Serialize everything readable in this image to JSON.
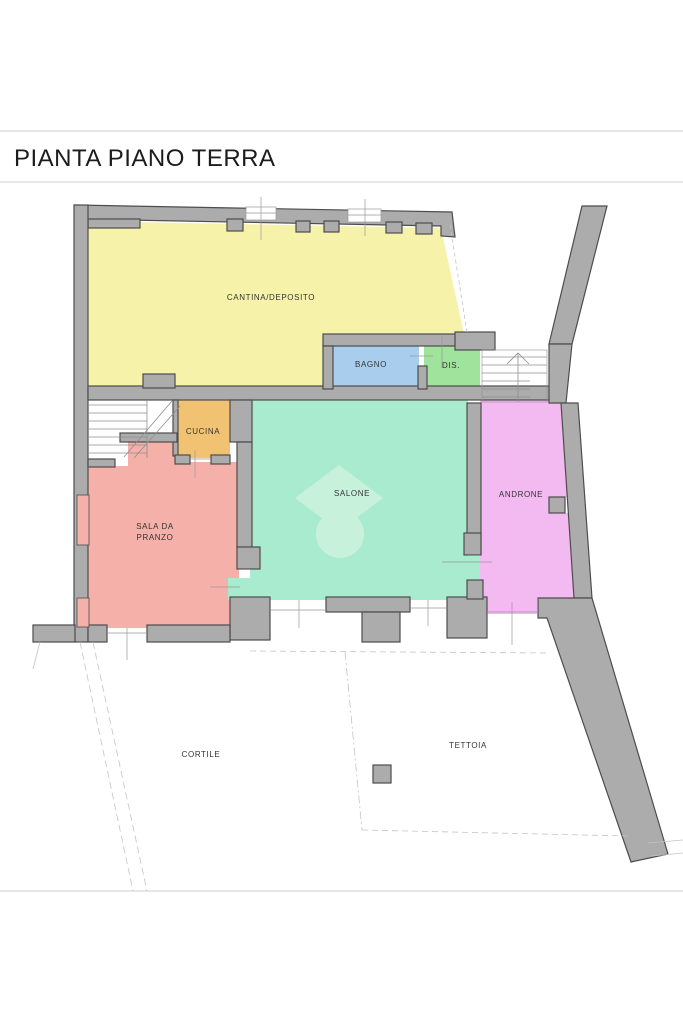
{
  "page": {
    "title": "PIANTA PIANO TERRA"
  },
  "theme": {
    "page_bg": "#ffffff",
    "border_line": "#d8d8d8",
    "title_color": "#1c1c1c",
    "label_color": "#333333",
    "wall_fill": "#acacac",
    "wall_stroke": "#4d4d4d",
    "thin_line": "#999999",
    "dashed_line": "#c4c4c4",
    "stair_line": "#8f8f8f",
    "watermark_color": "#c8f1dc",
    "opening_fill": "#ffffff"
  },
  "rooms": {
    "cantina": {
      "label": "CANTINA/DEPOSITO",
      "color": "#f7f2a9"
    },
    "bagno": {
      "label": "BAGNO",
      "color": "#a9cdec"
    },
    "dis": {
      "label": "DIS.",
      "color": "#a0e39c"
    },
    "cucina": {
      "label": "CUCINA",
      "color": "#f1c272"
    },
    "salone": {
      "label": "SALONE",
      "color": "#a9ebce"
    },
    "sala_da_pranzo": {
      "label_line1": "SALA DA",
      "label_line2": "PRANZO",
      "color": "#f5b0aa"
    },
    "androne": {
      "label": "ANDRONE",
      "color": "#f3b9f1"
    },
    "cortile": {
      "label": "CORTILE",
      "color": "#ffffff"
    },
    "tettoia": {
      "label": "TETTOIA",
      "color": "#ffffff"
    }
  }
}
